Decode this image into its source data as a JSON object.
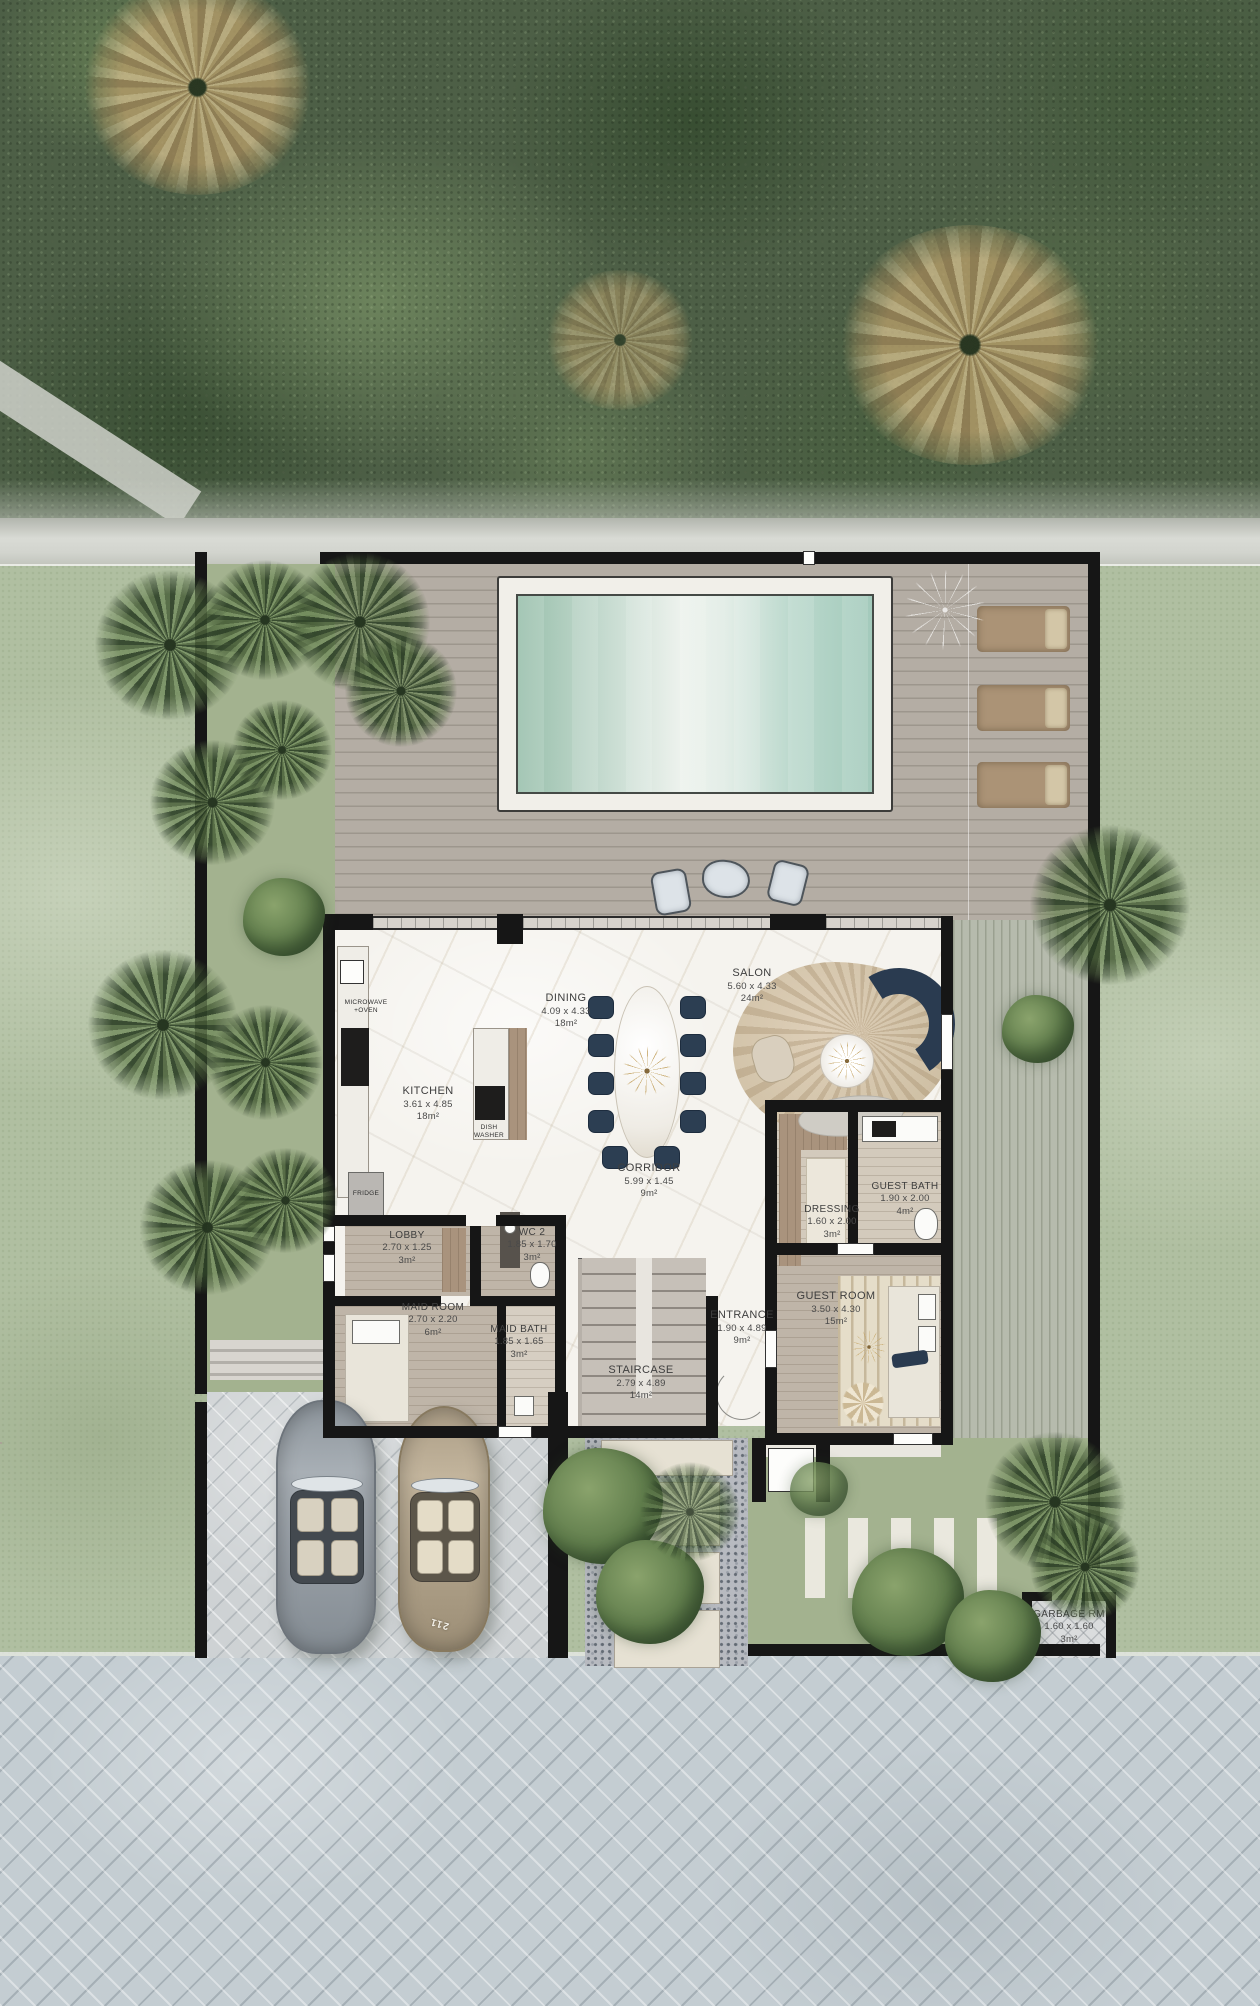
{
  "plan": {
    "type": "villa-ground-floor-plan",
    "rooms": {
      "dining": {
        "name": "DINING",
        "dims": "4.09 x 4.33",
        "area": "18m²"
      },
      "salon": {
        "name": "SALON",
        "dims": "5.60 x 4.33",
        "area": "24m²"
      },
      "kitchen": {
        "name": "KITCHEN",
        "dims": "3.61 x 4.85",
        "area": "18m²"
      },
      "corridor": {
        "name": "CORRIDOR",
        "dims": "5.99 x 1.45",
        "area": "9m²"
      },
      "lobby": {
        "name": "LOBBY",
        "dims": "2.70 x 1.25",
        "area": "3m²"
      },
      "wc2": {
        "name": "WC 2",
        "dims": "1.85 x 1.70",
        "area": "3m²"
      },
      "maid_room": {
        "name": "MAID ROOM",
        "dims": "2.70 x 2.20",
        "area": "6m²"
      },
      "maid_bath": {
        "name": "MAID BATH",
        "dims": "1.85 x 1.65",
        "area": "3m²"
      },
      "entrance": {
        "name": "ENTRANCE",
        "dims": "1.90 x 4.89",
        "area": "9m²"
      },
      "staircase": {
        "name": "STAIRCASE",
        "dims": "2.79 x 4.89",
        "area": "14m²"
      },
      "dressing": {
        "name": "DRESSING",
        "dims": "1.60 x 2.00",
        "area": "3m²"
      },
      "guest_bath": {
        "name": "GUEST BATH",
        "dims": "1.90 x 2.00",
        "area": "4m²"
      },
      "guest_room": {
        "name": "GUEST ROOM",
        "dims": "3.50 x 4.30",
        "area": "15m²"
      },
      "garbage": {
        "name": "GARBAGE RM",
        "dims": "1.60 x 1.60",
        "area": "3m²"
      }
    },
    "appliances": {
      "microwave_line1": "MICROWAVE",
      "microwave_line2": "+OVEN",
      "dishwasher_line1": "DISH",
      "dishwasher_line2": "WASHER",
      "fridge": "FRIDGE"
    },
    "vehicles": {
      "plate": "211"
    },
    "colors": {
      "wall": "#161616",
      "marble_floor": "#f5f3ee",
      "wood_deck": "#aaa49b",
      "pool_water_left": "#98bfab",
      "pool_water_mid": "#edf2ed",
      "pool_water_right": "#a3cabb",
      "lawn": "#b0bfa1",
      "forest": "#4d5f46",
      "road_paver": "#c4cdd2",
      "navy_furniture": "#2a3b50",
      "rug_beige": "#d7cab4",
      "lounger_tan": "#ab9376"
    }
  }
}
